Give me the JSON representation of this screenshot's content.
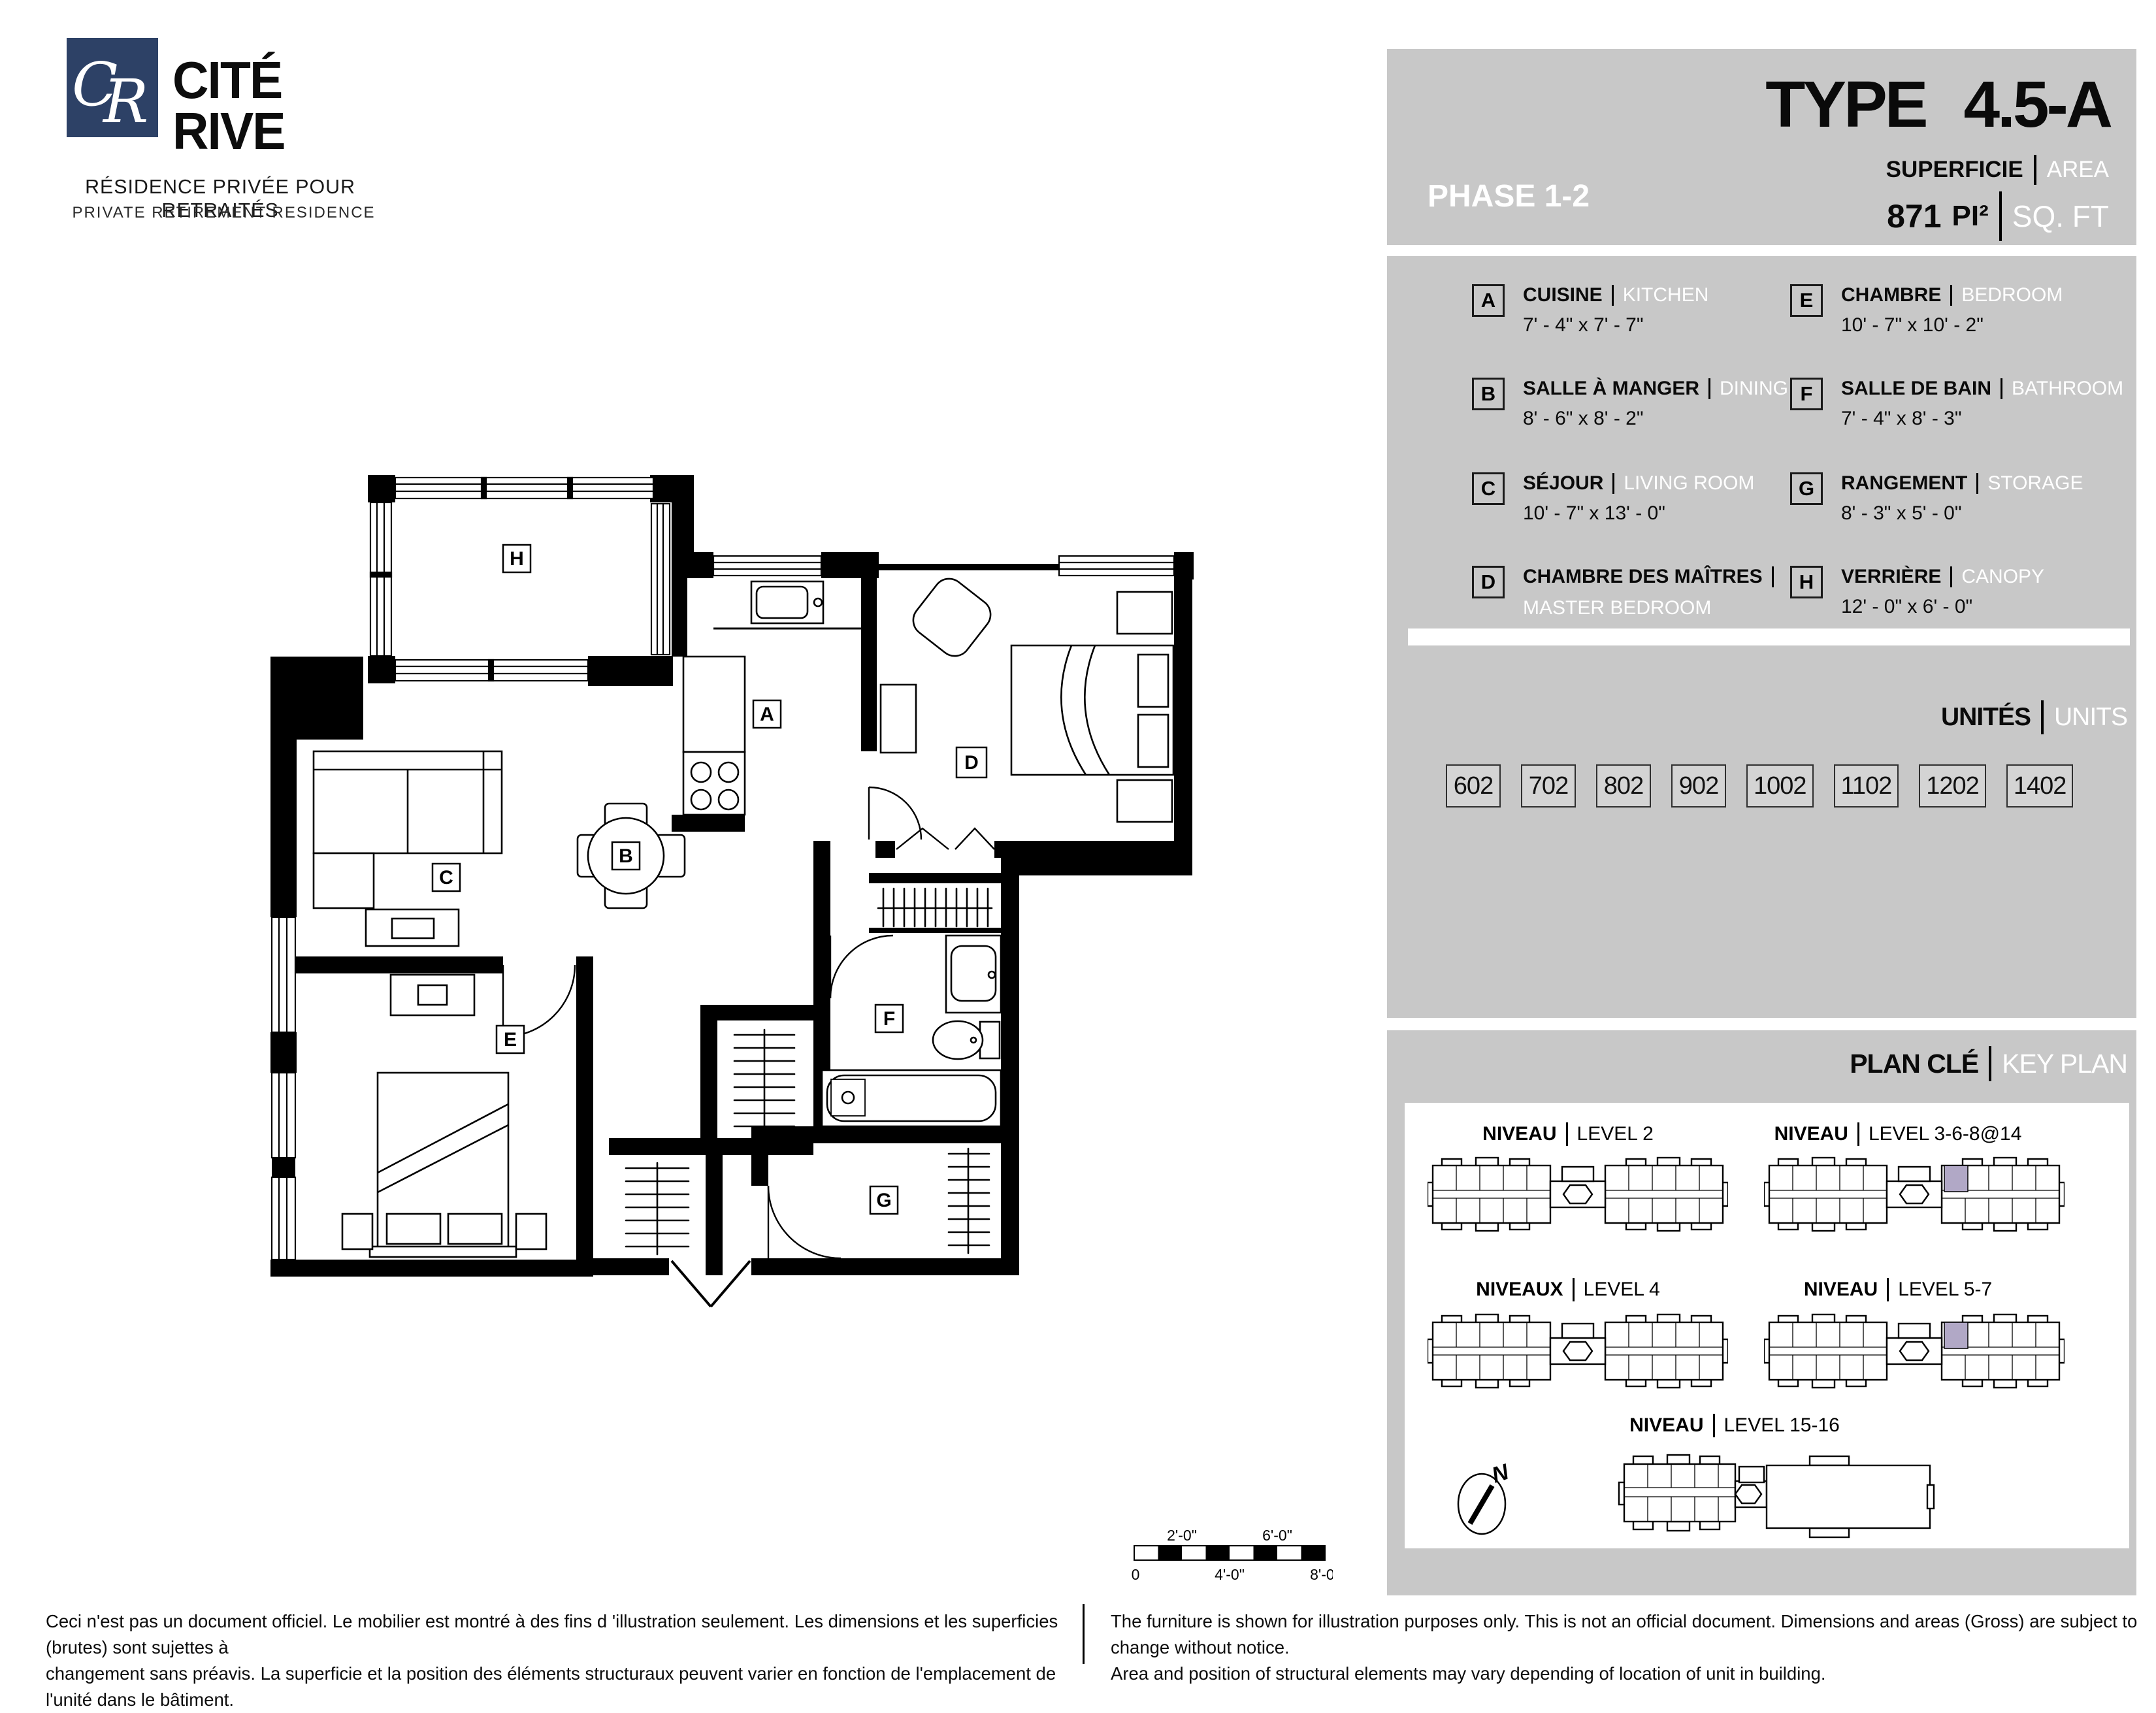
{
  "logo": {
    "monogram_c": "C",
    "monogram_r": "R",
    "name_line1": "CITÉ",
    "name_line2": "RIVE",
    "tagline_fr": "RÉSIDENCE PRIVÉE POUR RETRAITÉS",
    "tagline_en": "PRIVATE RETIREMENT RESIDENCE"
  },
  "header": {
    "phase": "PHASE 1-2",
    "type_label": "TYPE",
    "type_value": "4.5-A",
    "superficie_label": "SUPERFICIE",
    "area_label": "AREA",
    "area_value": "871",
    "area_unit_fr": "PI²",
    "area_unit_en": "SQ. FT"
  },
  "legend": {
    "items": [
      {
        "letter": "A",
        "name_fr": "CUISINE",
        "name_en": "KITCHEN",
        "dims": "7' - 4\" x 7' - 7\""
      },
      {
        "letter": "B",
        "name_fr": "SALLE À MANGER",
        "name_en": "DINING",
        "dims": "8' - 6\" x 8' - 2\""
      },
      {
        "letter": "C",
        "name_fr": "SÉJOUR",
        "name_en": "LIVING ROOM",
        "dims": "10' - 7\" x 13' - 0\""
      },
      {
        "letter": "D",
        "name_fr": "CHAMBRE DES MAÎTRES",
        "name_en": "MASTER BEDROOM",
        "dims": "12' - 5\" x 10' - 8\""
      },
      {
        "letter": "E",
        "name_fr": "CHAMBRE",
        "name_en": "BEDROOM",
        "dims": "10' - 7\" x 10' - 2\""
      },
      {
        "letter": "F",
        "name_fr": "SALLE DE BAIN",
        "name_en": "BATHROOM",
        "dims": "7' - 4\" x 8' - 3\""
      },
      {
        "letter": "G",
        "name_fr": "RANGEMENT",
        "name_en": "STORAGE",
        "dims": "8' - 3\" x 5' - 0\""
      },
      {
        "letter": "H",
        "name_fr": "VERRIÈRE",
        "name_en": "CANOPY",
        "dims": "12' - 0\" x 6' - 0\""
      }
    ]
  },
  "units": {
    "title_fr": "UNITÉS",
    "title_en": "UNITS",
    "numbers": [
      "602",
      "702",
      "802",
      "902",
      "1002",
      "1102",
      "1202",
      "1402"
    ]
  },
  "keyplan": {
    "title_fr": "PLAN CLÉ",
    "title_en": "KEY PLAN",
    "compass": "N",
    "plans": [
      {
        "label_fr": "NIVEAU",
        "label_en": "LEVEL 2",
        "highlight": false
      },
      {
        "label_fr": "NIVEAU",
        "label_en": "LEVEL 3-6-8@14",
        "highlight": true
      },
      {
        "label_fr": "NIVEAUX",
        "label_en": "LEVEL 4",
        "highlight": false
      },
      {
        "label_fr": "NIVEAU",
        "label_en": "LEVEL 5-7",
        "highlight": true
      },
      {
        "label_fr": "NIVEAU",
        "label_en": "LEVEL 15-16",
        "highlight": false
      }
    ]
  },
  "scalebar": {
    "top_labels": [
      "2'-0\"",
      "6'-0\""
    ],
    "bottom_labels": [
      "0",
      "4'-0\"",
      "8'-0\""
    ]
  },
  "disclaimer": {
    "fr_line1": "Ceci n'est pas un document officiel.  Le mobilier est montré à des fins d 'illustration seulement.  Les dimensions et les superficies (brutes) sont sujettes à",
    "fr_line2": "changement sans préavis. La superficie et la position des éléments structuraux peuvent varier en fonction de l'emplacement de l'unité dans le bâtiment.",
    "en_line1": "The furniture is shown for illustration purposes only.  This is not an official document.  Dimensions and areas (Gross) are subject to change without notice.",
    "en_line2": "Area and position of structural elements may vary depending of location of unit in building."
  },
  "colors": {
    "brand_blue": "#2d4166",
    "panel_gray": "#c8c8c8",
    "highlight_purple": "#b1a8c6"
  }
}
